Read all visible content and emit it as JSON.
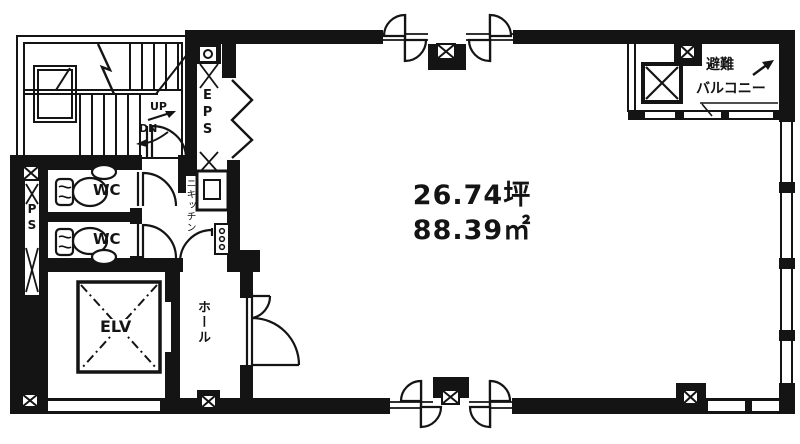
{
  "colors": {
    "ink": "#141414",
    "paper": "#ffffff"
  },
  "areas": {
    "tsubo": "26.74坪",
    "square_meters": "88.39㎡"
  },
  "labels": {
    "up": "UP",
    "down": "DN",
    "eps": "EPS",
    "ps": "PS",
    "wc_upper": "WC",
    "wc_lower": "WC",
    "mini_kitchen": "ミニキッチン",
    "elevator": "ELV",
    "hall": "ホール",
    "evacuation": "避難",
    "balcony": "バルコニー"
  }
}
